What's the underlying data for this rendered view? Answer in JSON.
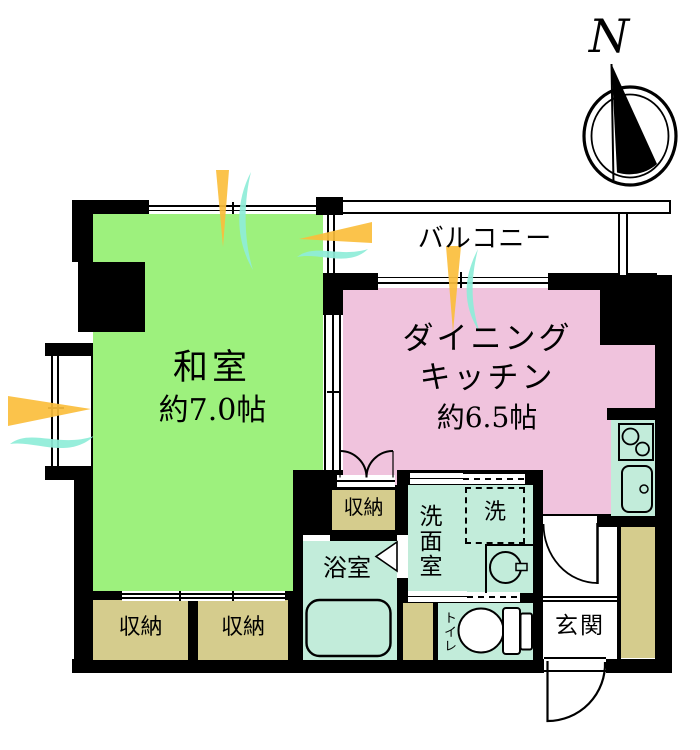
{
  "compass": {
    "north_label": "N"
  },
  "rooms": {
    "balcony": {
      "label": "バルコニー"
    },
    "washitsu": {
      "label": "和室",
      "size": "約7.0帖"
    },
    "dining_kitchen": {
      "label_line1": "ダイニング",
      "label_line2": "キッチン",
      "size": "約6.5帖"
    },
    "storage_middle": {
      "label": "収納"
    },
    "storage_bottom_left": {
      "label": "収納"
    },
    "storage_bottom_right": {
      "label": "収納"
    },
    "bathroom": {
      "label": "浴室"
    },
    "washroom": {
      "label": "洗面室"
    },
    "laundry": {
      "label": "洗"
    },
    "toilet": {
      "label": "トイレ"
    },
    "entrance": {
      "label": "玄関"
    }
  },
  "colors": {
    "wall": "#000000",
    "room-green": "#9df17d",
    "room-pink": "#f0c3dd",
    "room-mint": "#c2ecda",
    "room-tan": "#d5cc8d",
    "deco-orange": "#fbbe3c",
    "deco-aqua": "#8fedd9"
  }
}
